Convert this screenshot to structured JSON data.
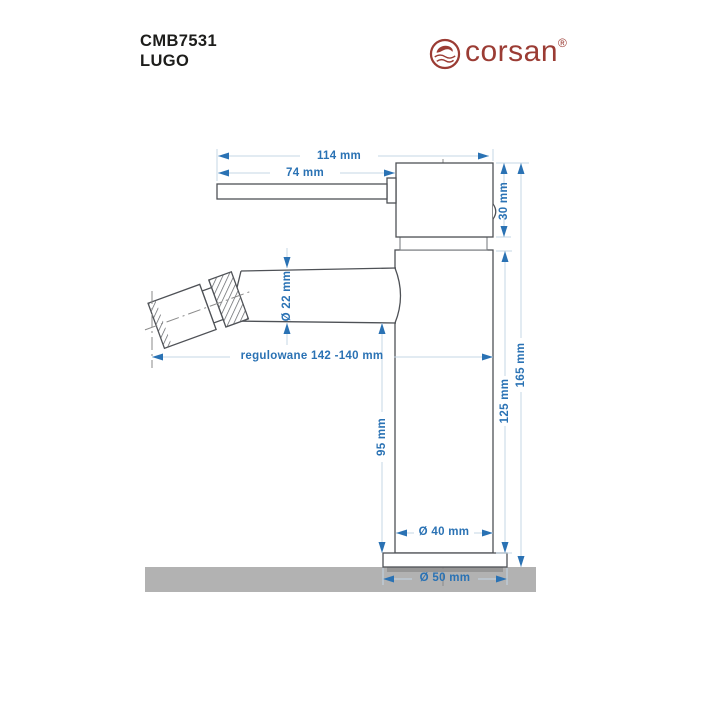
{
  "header": {
    "model": "CMB7531",
    "series": "LUGO",
    "brand": "corsan",
    "registered": "®"
  },
  "diagram": {
    "title": "bidet-faucet-technical-drawing",
    "dim_total_width": "114 mm",
    "dim_lever_length": "74 mm",
    "dim_head_height": "30 mm",
    "dim_spout_diameter": "Ø 22 mm",
    "dim_adjustable_reach": "regulowane 142 -140 mm",
    "dim_height_to_spout": "95 mm",
    "dim_body_height": "125 mm",
    "dim_total_height": "165 mm",
    "dim_body_diameter": "Ø 40 mm",
    "dim_base_diameter": "Ø 50 mm"
  },
  "colors": {
    "dimension_text": "#2a72b4",
    "dimension_line": "#c4d7e6",
    "outline": "#4e5156",
    "ground": "#b2b2b2",
    "brand_red": "#9b3c34",
    "heading_text": "#1d1d1b"
  }
}
